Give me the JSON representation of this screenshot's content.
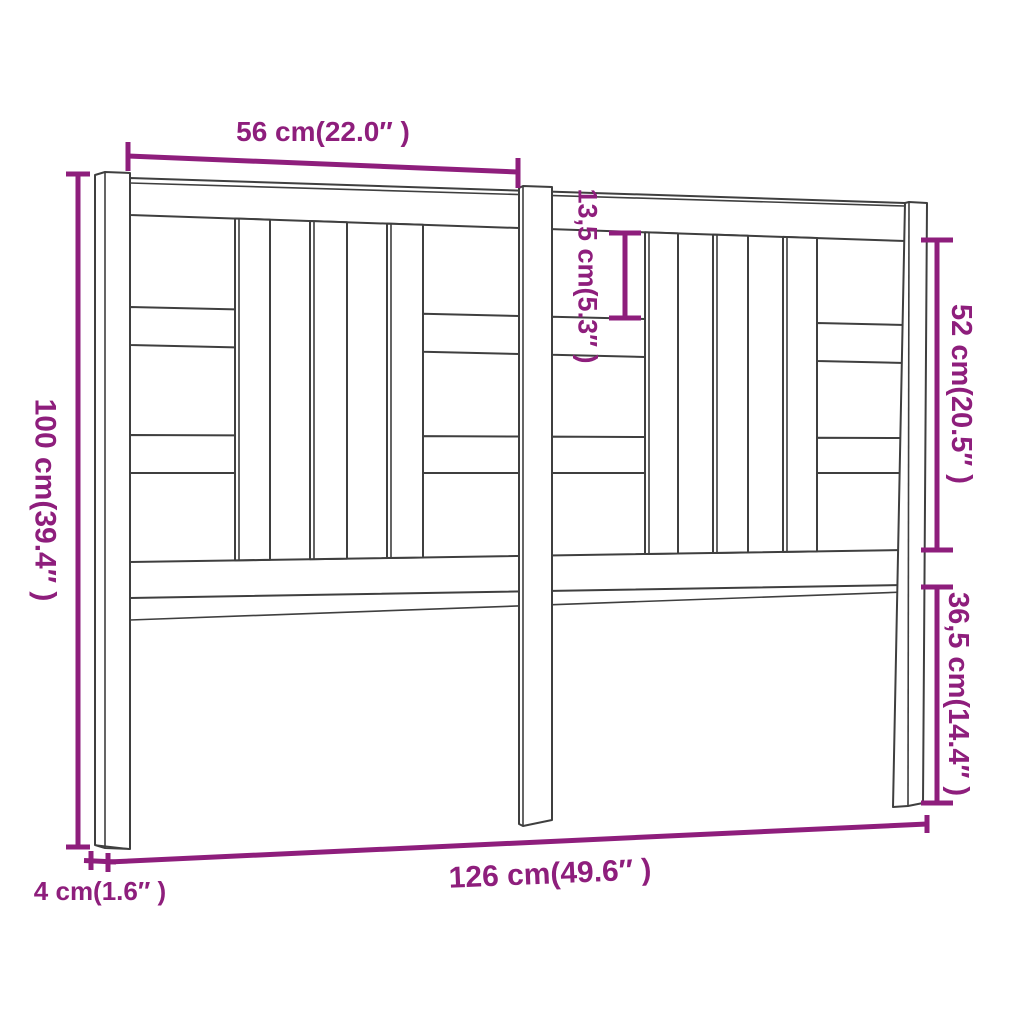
{
  "diagram": {
    "colors": {
      "dimension": "#8e1e7c",
      "outline": "#3f3f3f",
      "background": "#ffffff"
    },
    "dimensions": {
      "top_width": {
        "label": "56 cm(22.0″ )"
      },
      "height": {
        "label": "100 cm(39.4″ )"
      },
      "depth": {
        "label": "4 cm(1.6″ )"
      },
      "total_width": {
        "label": "126 cm(49.6″ )"
      },
      "upper_gap": {
        "label": "13,5 cm(5.3″ )"
      },
      "upper_side": {
        "label": "52 cm(20.5″ )"
      },
      "leg_height": {
        "label": "36,5 cm(14.4″ )"
      }
    }
  }
}
